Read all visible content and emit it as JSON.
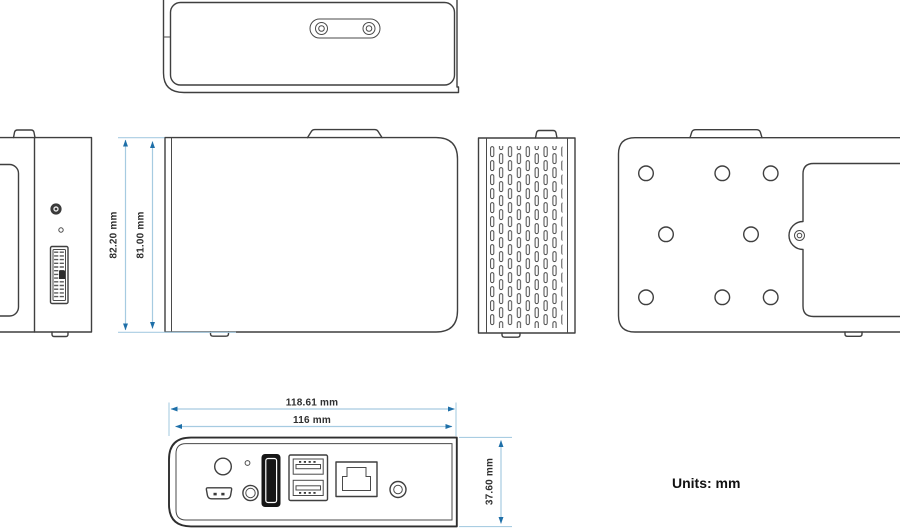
{
  "page": {
    "units_label": "Units: mm"
  },
  "dimensions": {
    "front_outer_height": "82.20 mm",
    "front_inner_height": "81.00 mm",
    "rear_outer_width": "118.61 mm",
    "rear_inner_width": "116 mm",
    "rear_panel_height": "37.60 mm"
  },
  "colors": {
    "outline": "#3f3f3f",
    "dim_line": "#a6cbe1",
    "dim_arrow": "#1e6fa8",
    "dim_text": "#2f2f2f",
    "hdmi_fill": "#161616",
    "background": "#ffffff"
  }
}
